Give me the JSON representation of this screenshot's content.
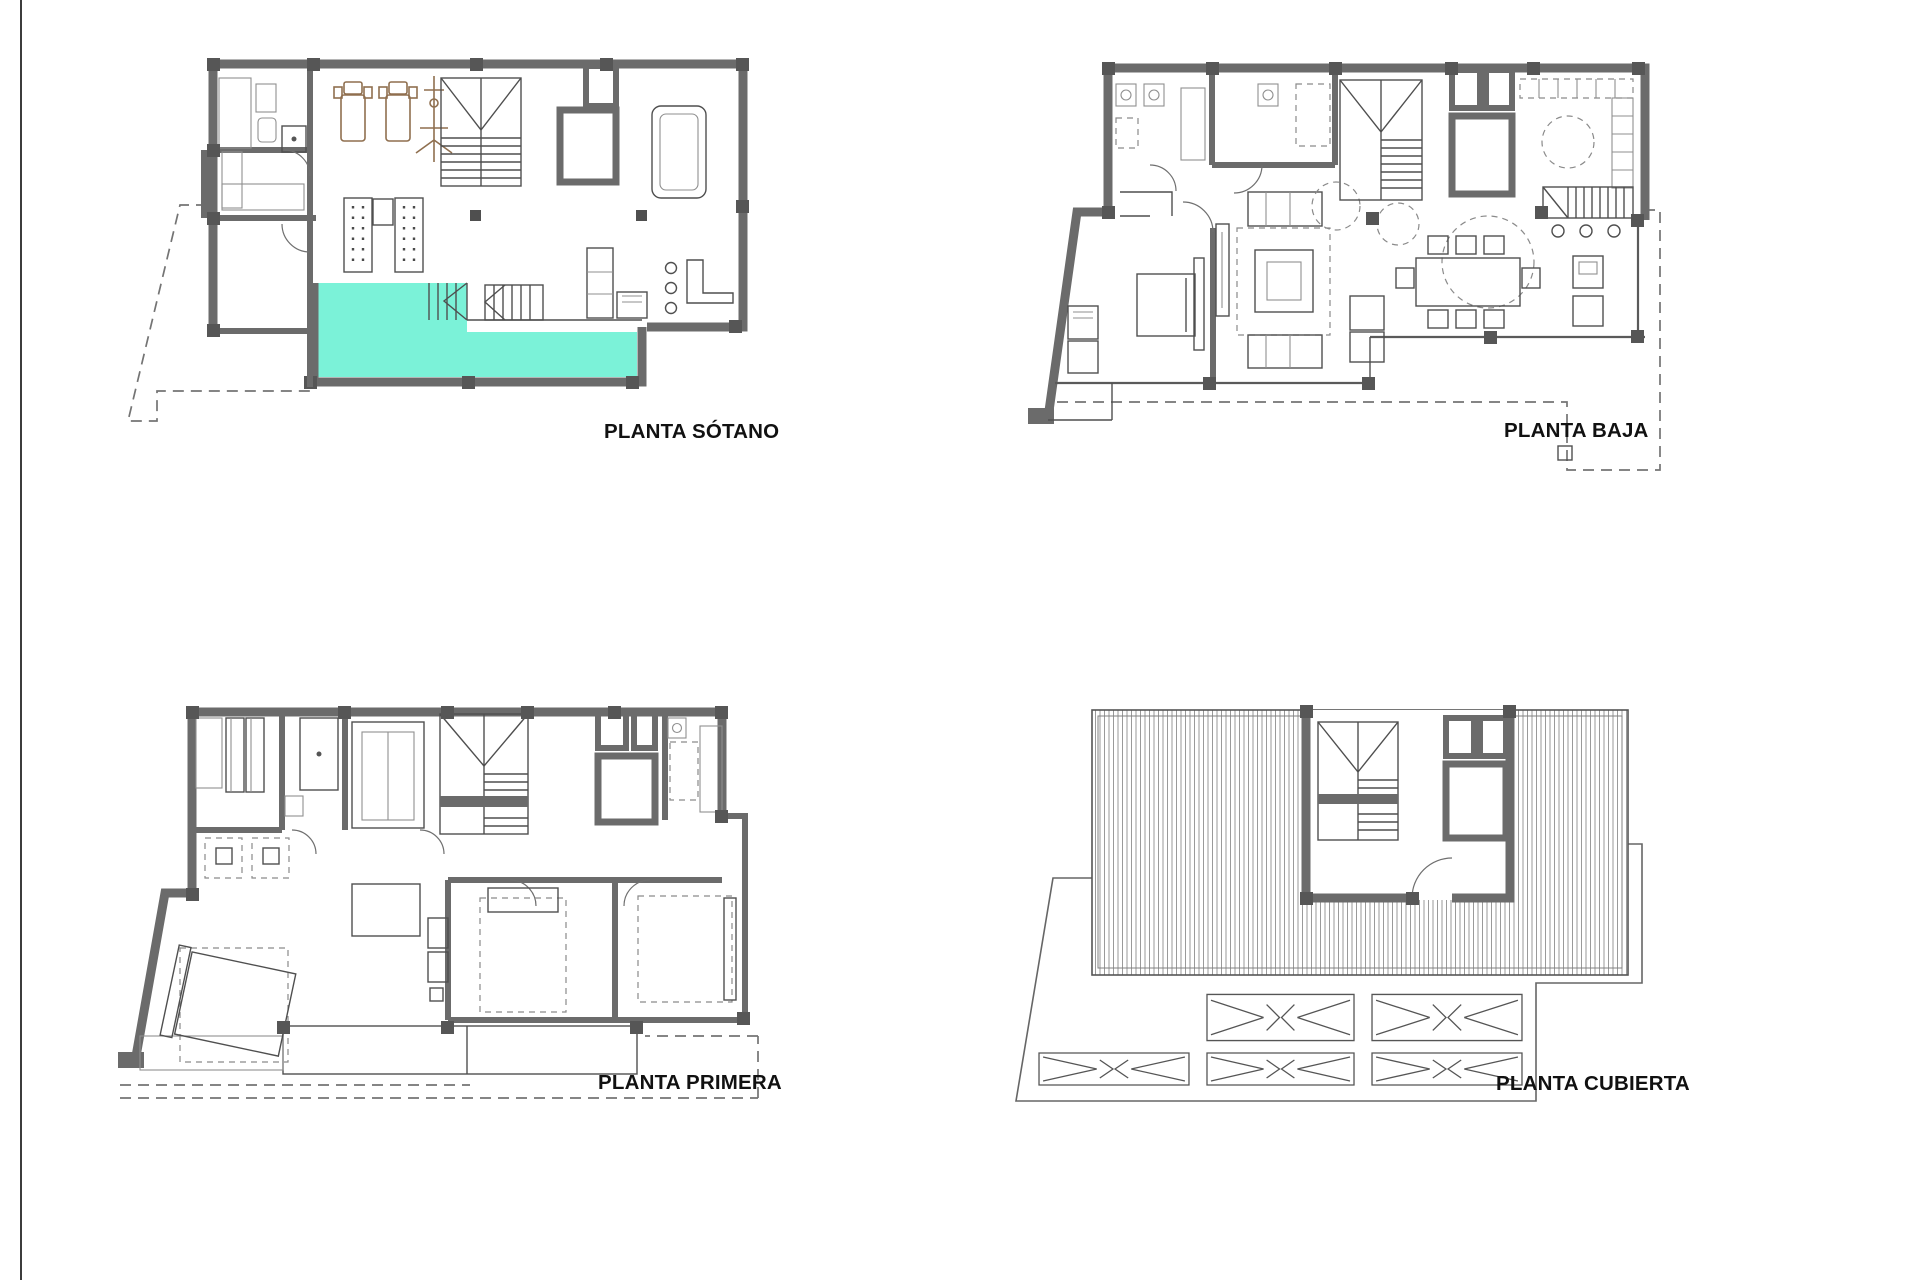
{
  "sheet": {
    "background": "#ffffff",
    "rule_color": "#3c3c3c"
  },
  "colors": {
    "pool_water": "#7bf2d8",
    "wall_gray": "#6b6b6b",
    "wood_brown": "#8f6f4f",
    "label_ink": "#111111"
  },
  "plans": [
    {
      "id": "sotano",
      "label": "PLANTA SÓTANO"
    },
    {
      "id": "baja",
      "label": "PLANTA BAJA"
    },
    {
      "id": "primera",
      "label": "PLANTA PRIMERA"
    },
    {
      "id": "cubierta",
      "label": "PLANTA CUBIERTA"
    }
  ]
}
